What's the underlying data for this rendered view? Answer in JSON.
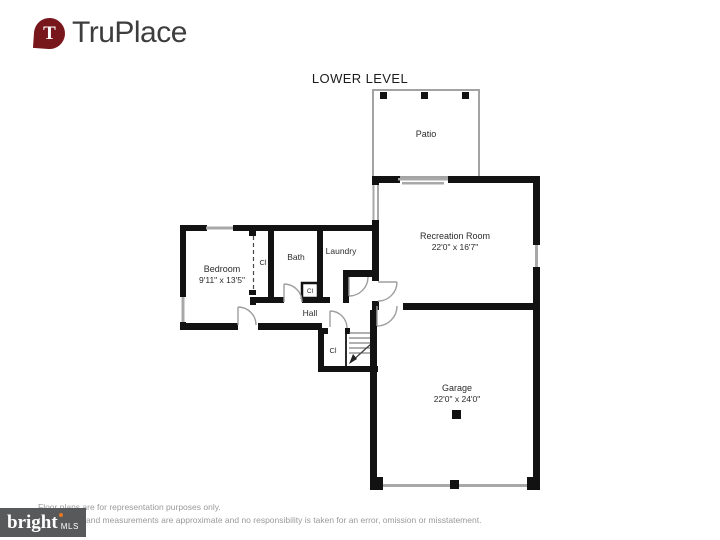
{
  "header": {
    "logo_text": "TruPlace",
    "title": "LOWER LEVEL"
  },
  "plan": {
    "patio": {
      "name": "Patio"
    },
    "recreation_room": {
      "name": "Recreation Room",
      "dims": "22'0\" x 16'7\""
    },
    "bedroom": {
      "name": "Bedroom",
      "dims": "9'11\" x 13'5\""
    },
    "bedroom_closet": {
      "name": "Cl"
    },
    "bath": {
      "name": "Bath"
    },
    "bath_closet": {
      "name": "Cl"
    },
    "laundry": {
      "name": "Laundry"
    },
    "hall": {
      "name": "Hall"
    },
    "hall_closet": {
      "name": "Cl"
    },
    "garage": {
      "name": "Garage",
      "dims": "22'0\" x 24'0\""
    }
  },
  "footer": {
    "disclaimer_line1": "Floor plans are for representation purposes only.",
    "disclaimer_line2": "and measurements are approximate and no responsibility is taken for an error, omission or misstatement.",
    "mls_logo_text": "bright",
    "mls_logo_suffix": "MLS"
  },
  "colors": {
    "wall": "#121212",
    "window_line": "#a8a8a8",
    "door_arc": "#9e9e9e",
    "pin_red": "#77161b",
    "logo_gray": "#3d3d3d",
    "mls_bg": "#58595b",
    "mls_accent": "#e87722",
    "label_text": "#2b2b2b",
    "muted_text": "#9a9a9a"
  }
}
